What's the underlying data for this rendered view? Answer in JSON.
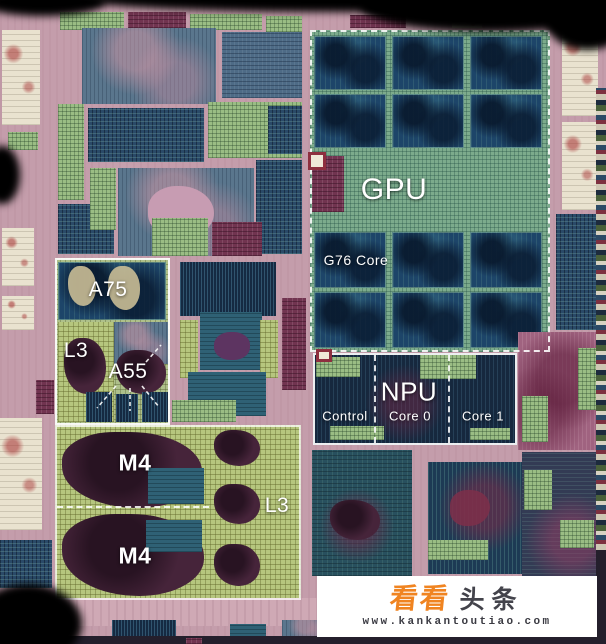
{
  "die_labels": {
    "gpu": "GPU",
    "gpu_core": "G76 Core",
    "npu": "NPU",
    "npu_control": "Control",
    "npu_core0": "Core 0",
    "npu_core1": "Core 1",
    "cpu_big": "A75",
    "cpu_l3": "L3",
    "cpu_little": "A55",
    "m4_top": "M4",
    "m4_bottom": "M4",
    "m4_l3": "L3"
  },
  "watermark": {
    "brand_first": "看看",
    "brand_second": "头条",
    "url": "www.kankantoutiao.com",
    "brand_color": "#f08421",
    "text_color": "#43434b",
    "background": "#ffffff"
  },
  "colors": {
    "substrate": "#c49dab",
    "gpu_core_blue": "#1d4569",
    "npu_dark": "#16283e",
    "m4_grid_green": "#b6c67e",
    "label_white": "#ffffff"
  },
  "die_blocks": [
    [
      "green",
      60,
      12,
      64,
      18
    ],
    [
      "maroon",
      128,
      12,
      58,
      16
    ],
    [
      "green",
      190,
      14,
      72,
      16
    ],
    [
      "green",
      266,
      16,
      36,
      80
    ],
    [
      "maroon",
      350,
      15,
      56,
      13
    ],
    [
      "cream",
      452,
      18,
      30,
      10
    ],
    [
      "cream",
      2,
      30,
      38,
      95
    ],
    [
      "green",
      8,
      132,
      30,
      18
    ],
    [
      "cream",
      2,
      228,
      32,
      58
    ],
    [
      "cream",
      2,
      296,
      32,
      34
    ],
    [
      "cream",
      0,
      418,
      42,
      112
    ],
    [
      "navy",
      0,
      540,
      52,
      48
    ],
    [
      "maroon",
      36,
      380,
      18,
      34
    ],
    [
      "slate",
      82,
      28,
      134,
      76
    ],
    [
      "slate2",
      222,
      32,
      80,
      66
    ],
    [
      "navy",
      88,
      108,
      116,
      54
    ],
    [
      "green",
      208,
      102,
      94,
      56
    ],
    [
      "green",
      58,
      104,
      26,
      96
    ],
    [
      "slate",
      118,
      168,
      136,
      88
    ],
    [
      "bpink",
      148,
      186,
      66,
      52
    ],
    [
      "navy",
      256,
      160,
      46,
      94
    ],
    [
      "navy",
      58,
      204,
      56,
      50
    ],
    [
      "green",
      90,
      168,
      26,
      62
    ],
    [
      "green",
      152,
      218,
      56,
      38
    ],
    [
      "maroon",
      212,
      222,
      50,
      34
    ],
    [
      "navy",
      268,
      106,
      34,
      48
    ],
    [
      "navycell",
      180,
      262,
      96,
      54
    ],
    [
      "m4",
      180,
      320,
      18,
      58
    ],
    [
      "teal",
      200,
      312,
      62,
      58
    ],
    [
      "bpurple",
      214,
      332,
      36,
      28
    ],
    [
      "m4",
      260,
      320,
      18,
      58
    ],
    [
      "teal",
      188,
      372,
      78,
      44
    ],
    [
      "maroon",
      282,
      298,
      24,
      92
    ],
    [
      "green",
      172,
      400,
      64,
      22
    ],
    [
      "gpubase",
      310,
      30,
      240,
      322
    ],
    [
      "core",
      314,
      36,
      72,
      54
    ],
    [
      "core",
      392,
      36,
      72,
      54
    ],
    [
      "core",
      470,
      36,
      72,
      54
    ],
    [
      "core",
      314,
      94,
      72,
      54
    ],
    [
      "core",
      392,
      94,
      72,
      54
    ],
    [
      "core",
      470,
      94,
      72,
      54
    ],
    [
      "core",
      314,
      232,
      72,
      56
    ],
    [
      "core",
      392,
      232,
      72,
      56
    ],
    [
      "core",
      470,
      232,
      72,
      56
    ],
    [
      "core",
      314,
      292,
      72,
      56
    ],
    [
      "core",
      392,
      292,
      72,
      56
    ],
    [
      "core",
      470,
      292,
      72,
      56
    ],
    [
      "maroon",
      312,
      156,
      32,
      56
    ],
    [
      "npu",
      313,
      353,
      204,
      92
    ],
    [
      "green",
      316,
      357,
      44,
      20
    ],
    [
      "green",
      420,
      355,
      56,
      24
    ],
    [
      "green",
      330,
      426,
      54,
      14
    ],
    [
      "green",
      470,
      428,
      40,
      12
    ],
    [
      "cream",
      562,
      24,
      36,
      92
    ],
    [
      "cream",
      562,
      122,
      36,
      88
    ],
    [
      "navy",
      556,
      214,
      50,
      116
    ],
    [
      "rose",
      518,
      332,
      88,
      118
    ],
    [
      "green",
      522,
      396,
      26,
      46
    ],
    [
      "green",
      578,
      348,
      22,
      62
    ],
    [
      "darkmix",
      522,
      452,
      84,
      126
    ],
    [
      "green",
      524,
      470,
      28,
      40
    ],
    [
      "green",
      560,
      520,
      34,
      28
    ],
    [
      "iostrip",
      596,
      88,
      10,
      462
    ],
    [
      "navy",
      558,
      580,
      48,
      58
    ],
    [
      "tealdark",
      312,
      450,
      100,
      126
    ],
    [
      "bmaroon",
      330,
      500,
      50,
      40
    ],
    [
      "navycell2",
      428,
      462,
      94,
      112
    ],
    [
      "bred",
      450,
      490,
      40,
      36
    ],
    [
      "green",
      428,
      540,
      60,
      20
    ],
    [
      "clusterbase",
      55,
      258,
      115,
      167
    ],
    [
      "core",
      58,
      262,
      108,
      58
    ],
    [
      "btan",
      108,
      266,
      32,
      44
    ],
    [
      "btan",
      68,
      266,
      28,
      40
    ],
    [
      "m4",
      58,
      322,
      56,
      100
    ],
    [
      "bmaroon",
      64,
      338,
      42,
      56
    ],
    [
      "slate",
      114,
      322,
      54,
      42
    ],
    [
      "bmaroon",
      116,
      350,
      50,
      44
    ],
    [
      "navycell",
      86,
      392,
      26,
      30
    ],
    [
      "navycell",
      116,
      394,
      22,
      28
    ],
    [
      "navycell",
      142,
      392,
      26,
      30
    ],
    [
      "m4base",
      55,
      425,
      246,
      175
    ],
    [
      "bmaroon",
      62,
      432,
      140,
      76
    ],
    [
      "teal",
      148,
      468,
      56,
      36
    ],
    [
      "bmaroon",
      62,
      514,
      142,
      82
    ],
    [
      "teal",
      146,
      520,
      56,
      32
    ],
    [
      "bmaroon",
      214,
      430,
      46,
      36
    ],
    [
      "bmaroon",
      214,
      484,
      46,
      40
    ],
    [
      "bmaroon",
      214,
      544,
      46,
      42
    ],
    [
      "subl",
      60,
      598,
      546,
      28
    ],
    [
      "navycell",
      112,
      620,
      64,
      20
    ],
    [
      "slate",
      282,
      620,
      58,
      18
    ],
    [
      "navy",
      478,
      618,
      72,
      20
    ],
    [
      "teal",
      230,
      624,
      36,
      14
    ],
    [
      "darkedge",
      60,
      636,
      546,
      8
    ],
    [
      "maroon",
      186,
      638,
      16,
      6
    ],
    [
      "darkedge",
      596,
      550,
      10,
      94
    ]
  ]
}
